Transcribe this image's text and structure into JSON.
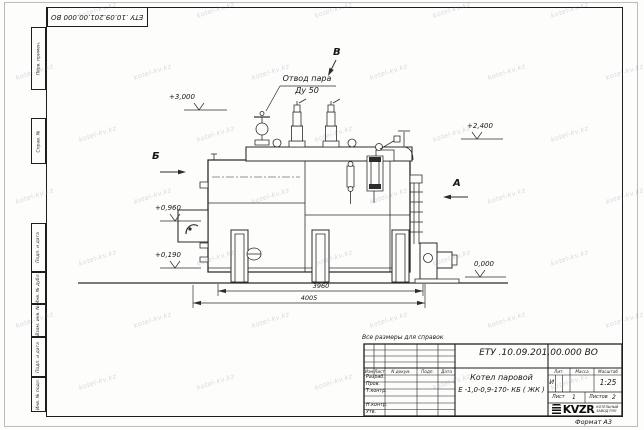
{
  "sheet": {
    "top_stamp": "ЕТУ .10.09.201.00.000  ВО",
    "format_label": "Формат А3",
    "reference_note": "Все размеры для справок",
    "side_labels": [
      "Перв. примен.",
      "Справ. №",
      "Подп. и дата",
      "Инв. № дубл.",
      "Взам. инв. №",
      "Подп. и дата",
      "Инв. № подл."
    ]
  },
  "watermark": {
    "text": "kotel-kv.kz"
  },
  "drawing": {
    "callout_line1": "Отвод пара",
    "callout_line2": "Ду 50",
    "view_top": "В",
    "view_left": "Б",
    "view_right": "А",
    "elev_top": "+3,000",
    "elev_right": "+2,400",
    "elev_burner": "+0,960",
    "elev_low": "+0,190",
    "elev_ground": "0,000",
    "dim_inner": "3960",
    "dim_outer": "4005"
  },
  "title_block": {
    "designation": "ЕТУ .10.09.201.00.000  ВО",
    "name_line1": "Котел паровой",
    "name_line2": "Е -1,0-0,9-170- КБ ( ЖК )",
    "header_cols": [
      "Изм",
      "Лист",
      "N докум.",
      "Подп.",
      "Дата"
    ],
    "row_labels": [
      "Разраб.",
      "Пров.",
      "Т.контр.",
      "",
      "Н.контр.",
      "Утв."
    ],
    "lit_header": "Лит.",
    "mass_header": "Масса",
    "scale_header": "Масштаб",
    "lit_value": "И",
    "scale_value": "1:25",
    "sheet_label": "Лист",
    "sheet_value": "1",
    "sheets_label": "Листов",
    "sheets_value": "2",
    "logo_text": "KVZR",
    "logo_sub1": "КОТЕЛЬНЫЙ",
    "logo_sub2": "ЗАВОД РЭП"
  }
}
